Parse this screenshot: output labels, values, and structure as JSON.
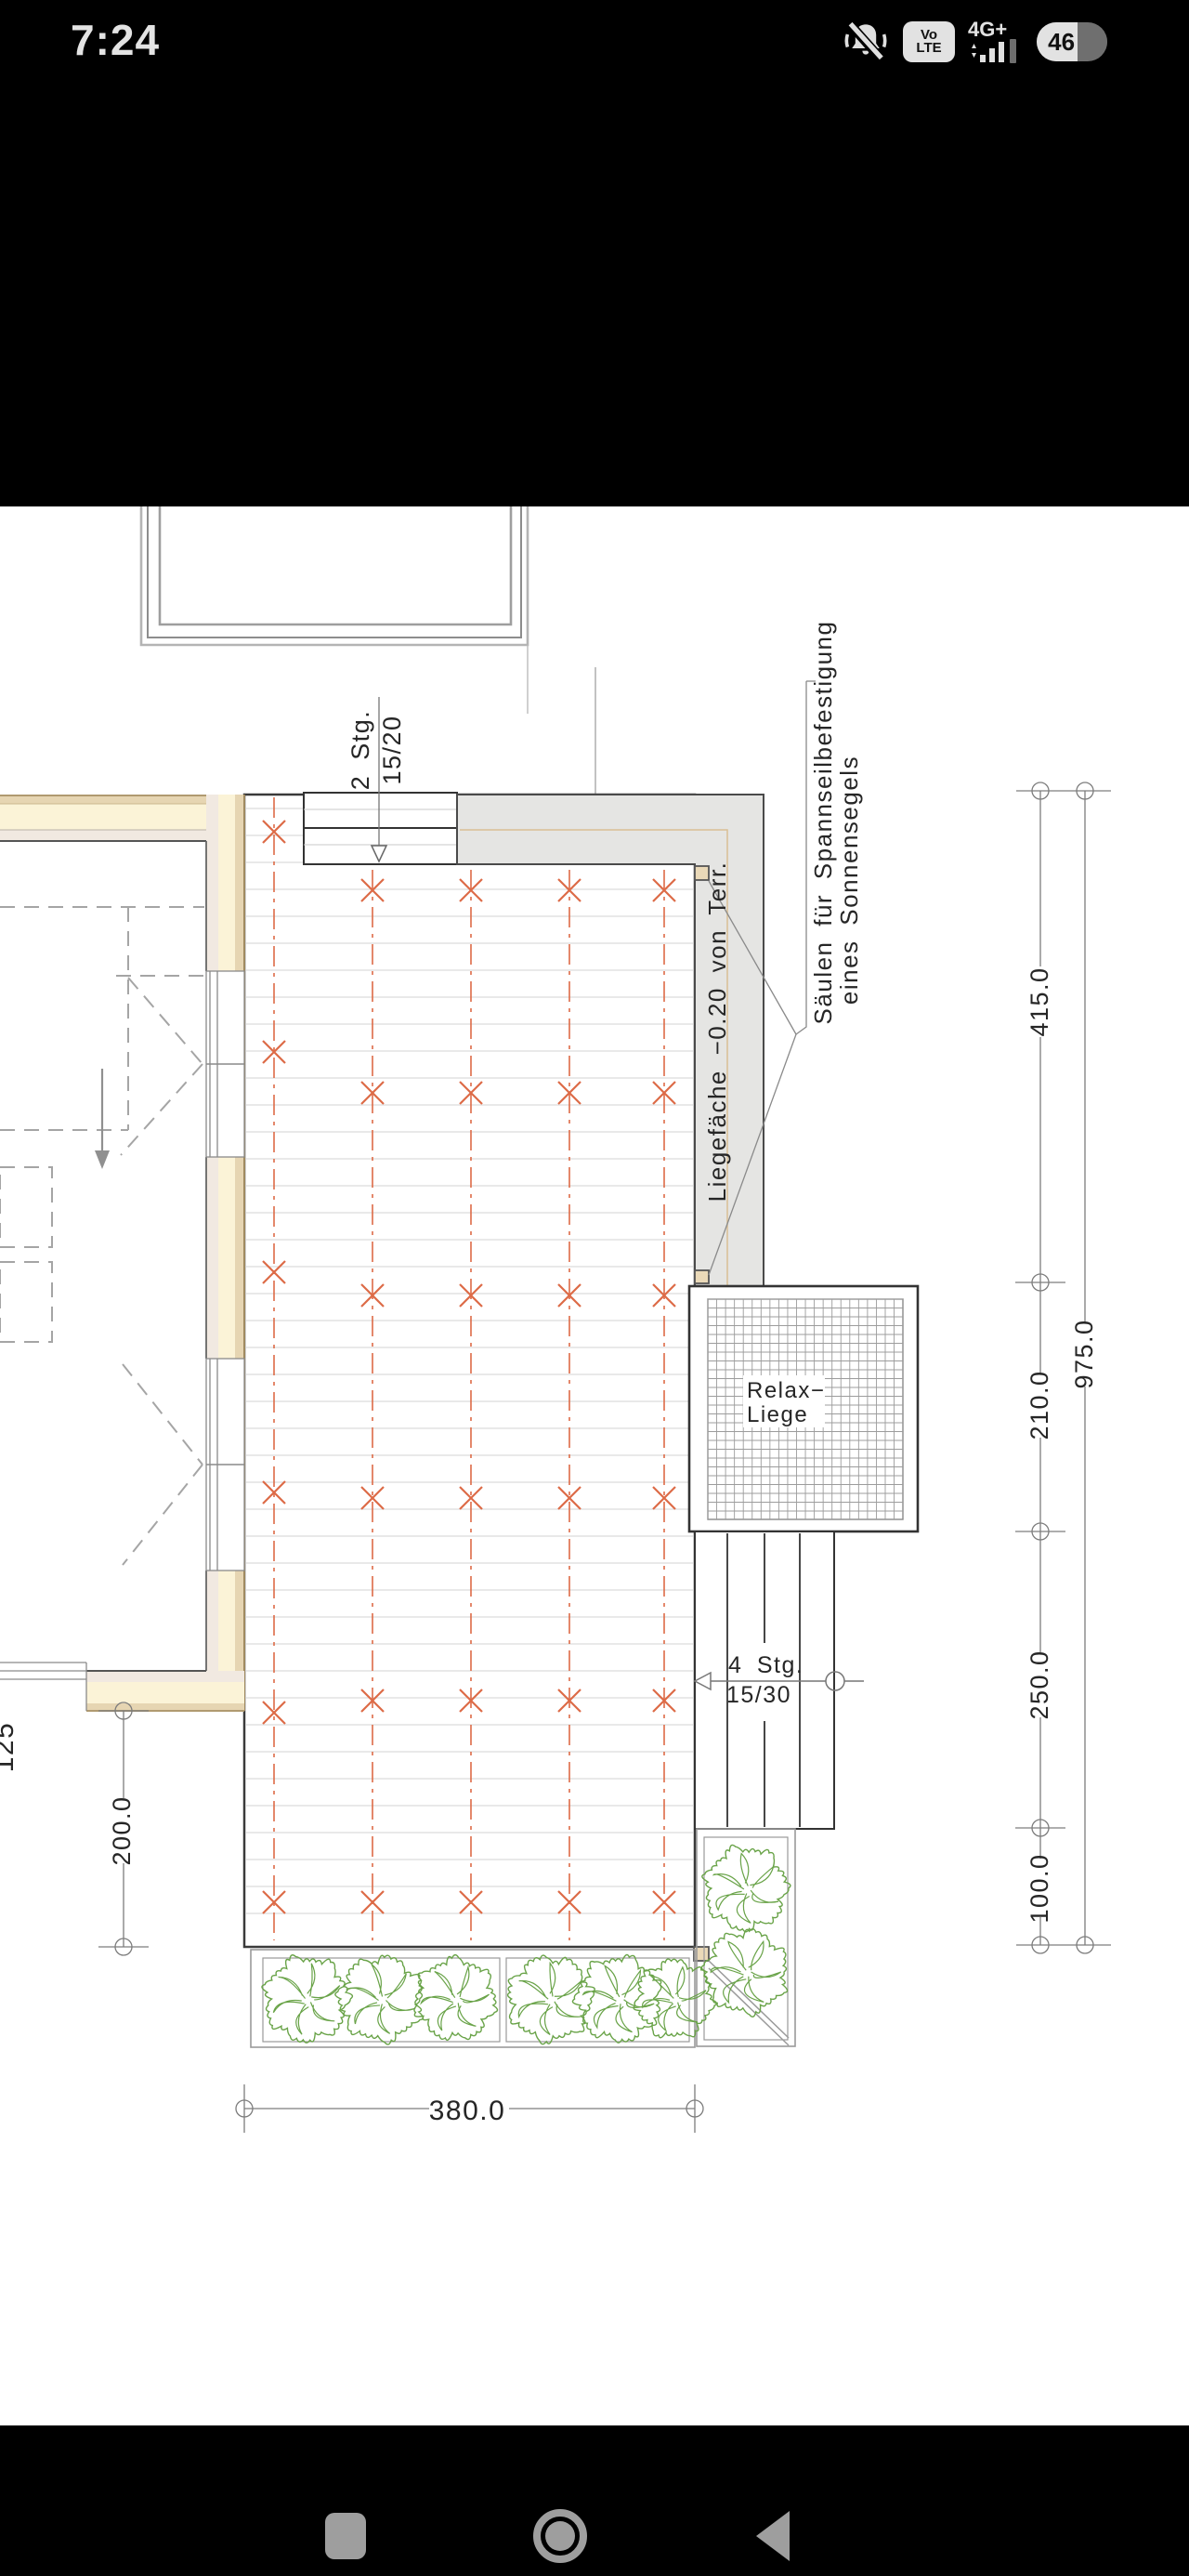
{
  "status_bar": {
    "time": "7:24",
    "volte_line1": "Vo",
    "volte_line2": "LTE",
    "network": "4G+",
    "battery_percent": "46"
  },
  "drawing": {
    "labels": {
      "stairs_top_line1": "2 Stg.",
      "stairs_top_line2": "15/20",
      "saeulen_line1": "Säulen für Spannseilbefestigung",
      "saeulen_line2": "eines Sonnensegels",
      "liegeflaeche": "Liegefäche −0.20 von Terr.",
      "relax_line1": "Relax−",
      "relax_line2": "Liege",
      "stairs_right_line1": "4 Stg.",
      "stairs_right_line2": "15/30"
    },
    "dimensions": {
      "right_segments": [
        "415.0",
        "210.0",
        "250.0",
        "100.0"
      ],
      "right_total": "975.0",
      "left_vertical": "200.0",
      "left_edge_partial": "125",
      "bottom": "380.0"
    },
    "colors": {
      "orange": "#dd6b47",
      "green": "#69a348",
      "wall_cream": "#fbf3d7",
      "wall_tan": "#e6d5b2",
      "wall_inner": "#f1e9e1",
      "terrace_gray": "#e5e5e3",
      "column_beige": "#ead9b8"
    }
  },
  "nav_bar": {
    "recents_icon": "recents-square",
    "home_icon": "home-circle",
    "back_icon": "back-triangle"
  }
}
